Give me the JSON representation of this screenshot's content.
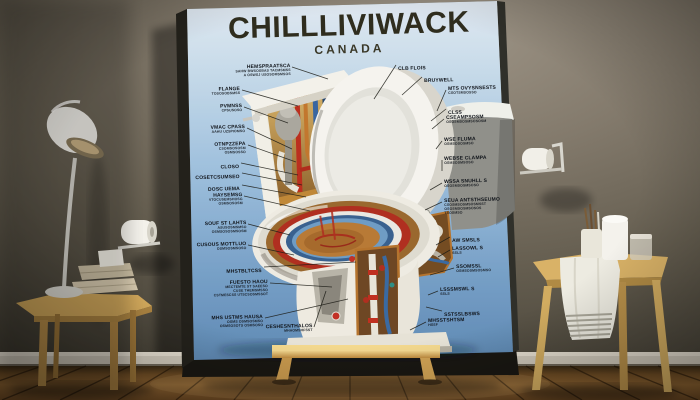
{
  "poster": {
    "title": "CHILLLIVIWACK",
    "subtitle": "CANADA",
    "title_color": "#2f2d1e",
    "bg_top": "#eef6fc",
    "bg_bottom": "#6490bb",
    "left_labels": [
      {
        "text": [
          "HEMSPRAATSCA",
          "SAHW BWSOSBAS TACMSMSS",
          "A OSWSJ USOSOMSMSOS"
        ],
        "x": 290,
        "y": 63,
        "target": [
          328,
          79
        ]
      },
      {
        "text": [
          "FLANGE",
          "TOSOSOBSMSS"
        ],
        "x": 240,
        "y": 86,
        "target": [
          298,
          106
        ]
      },
      {
        "text": [
          "PVMNSS",
          "CPSUSOSO"
        ],
        "x": 242,
        "y": 103,
        "target": [
          288,
          123
        ]
      },
      {
        "text": [
          "VMAC CPASS",
          "AAHU UZSPIOMSO"
        ],
        "x": 245,
        "y": 124,
        "target": [
          292,
          149
        ]
      },
      {
        "text": [
          "OTNPZZEPA",
          "CSOMSOSOSM",
          "OSMSOSSO"
        ],
        "x": 246,
        "y": 141,
        "target": [
          296,
          162
        ]
      },
      {
        "text": [
          "CLOSO"
        ],
        "x": 239,
        "y": 159,
        "target": [
          298,
          175
        ]
      },
      {
        "text": [
          "COSETCSUMSEO"
        ],
        "x": 240,
        "y": 169,
        "target": [
          302,
          185
        ]
      },
      {
        "text": [
          "DOSC UEMA"
        ],
        "x": 240,
        "y": 181,
        "target": [
          306,
          197
        ]
      },
      {
        "text": [
          "HAYSEMSG",
          "VTOCUSEMSHOSG",
          "OSMSOSOSM"
        ],
        "x": 242,
        "y": 192,
        "target": [
          310,
          211
        ]
      },
      {
        "text": [
          "SOUF ST LAHTS",
          "ASUSOSMSMSO",
          "OSMSOSOSMSOSM"
        ],
        "x": 246,
        "y": 220,
        "target": [
          290,
          235
        ]
      },
      {
        "text": [
          "CUSOUS MOTTLUO",
          "OSMSOSMSOSO"
        ],
        "x": 246,
        "y": 241,
        "target": [
          294,
          255
        ]
      },
      {
        "text": [
          "MHSTBLTCSS"
        ],
        "x": 262,
        "y": 263,
        "target": [
          356,
          262
        ]
      },
      {
        "text": [
          "FUESTO HAOU",
          "MECTEMTE ST SAEESO",
          "CUSE THEMSMSSO",
          "CSTMESCSS UTSCSOSMSSOT"
        ],
        "x": 268,
        "y": 279,
        "target": [
          332,
          287
        ]
      },
      {
        "text": [
          "MHS USTMS HAUSA",
          "OSMS OSMSOSMSO",
          "OSMSOSOTS OSMSOSO"
        ],
        "x": 263,
        "y": 314,
        "target": [
          348,
          299
        ]
      },
      {
        "text": [
          "CESHESNTHALOS",
          "MHAOMSHFSST"
        ],
        "x": 312,
        "y": 323,
        "target": [
          326,
          291
        ]
      }
    ],
    "right_labels": [
      {
        "text": [
          "CLB FLOIS"
        ],
        "x": 398,
        "y": 61,
        "target": [
          374,
          99
        ]
      },
      {
        "text": [
          "BRUYWELL"
        ],
        "x": 424,
        "y": 73,
        "target": [
          402,
          95
        ]
      },
      {
        "text": [
          "MTS OVYSNSESTS",
          "CSOTSMSOSSO"
        ],
        "x": 448,
        "y": 86,
        "target": [
          437,
          111
        ]
      },
      {
        "text": [
          "CLSS"
        ],
        "x": 448,
        "y": 105,
        "target": [
          431,
          121
        ]
      },
      {
        "text": [
          "CSEAMPSOSM",
          "OSOSMSOSMSOSOSM"
        ],
        "x": 446,
        "y": 115,
        "target": [
          432,
          129
        ]
      },
      {
        "text": [
          "WSE FLUMA",
          "OSMSOSOSMSO"
        ],
        "x": 444,
        "y": 137,
        "target": [
          436,
          149
        ]
      },
      {
        "text": [
          "WEBSE CLAMPA",
          "OSMSOSMSOSO"
        ],
        "x": 444,
        "y": 156,
        "target": [
          442,
          171
        ]
      },
      {
        "text": [
          "WSSA SNUHLL S",
          "OSOSMSOSMSOSO"
        ],
        "x": 444,
        "y": 179,
        "target": [
          430,
          190
        ]
      },
      {
        "text": [
          "SEUA ANTSTHSEUMO",
          "CSOSMSOSMSOSMSST",
          "OSOSMSOSMSOSOS",
          "TSOSMSO"
        ],
        "x": 444,
        "y": 198,
        "target": [
          425,
          210
        ]
      },
      {
        "text": [
          "AW SMSLS"
        ],
        "x": 452,
        "y": 233,
        "target": [
          436,
          245
        ]
      },
      {
        "text": [
          "LASSOWL S",
          "SSLS"
        ],
        "x": 452,
        "y": 246,
        "target": [
          438,
          257
        ]
      },
      {
        "text": [
          "SSOMSSL",
          "OSMSOSMSOSMSO"
        ],
        "x": 456,
        "y": 264,
        "target": [
          430,
          275
        ]
      },
      {
        "text": [
          "LSSSMSWL S",
          "SSLS"
        ],
        "x": 440,
        "y": 287,
        "target": [
          428,
          295
        ]
      },
      {
        "text": [
          "SSTSSLBSWS"
        ],
        "x": 444,
        "y": 307,
        "target": [
          426,
          307
        ]
      },
      {
        "text": [
          "MHSSTSHTSM",
          "HSSF"
        ],
        "x": 428,
        "y": 318,
        "target": [
          410,
          330
        ]
      }
    ]
  },
  "illustration": {
    "subject": "cutaway-toilet-diagram",
    "pipe_red": "#b13422",
    "pipe_blue": "#3c6da4",
    "pipe_copper": "#c2772e",
    "bowl_water": "#b87a36",
    "ring_red": "#b02f20",
    "ring_blue": "#39618f",
    "porcelain": "#f2efe8"
  },
  "room": {
    "wall_color": "#6b6357",
    "floor_color": "#7a5226",
    "baseboard_color": "#cfc8ba",
    "easel_wood": "#c79a4c",
    "objects": [
      "desk-lamp",
      "side-table",
      "book-stack",
      "toilet-paper-roll-left",
      "toilet-paper-roll-right",
      "wooden-stool",
      "towel",
      "brush-cup",
      "paper-roll",
      "glass-jar",
      "easel-stand"
    ]
  }
}
